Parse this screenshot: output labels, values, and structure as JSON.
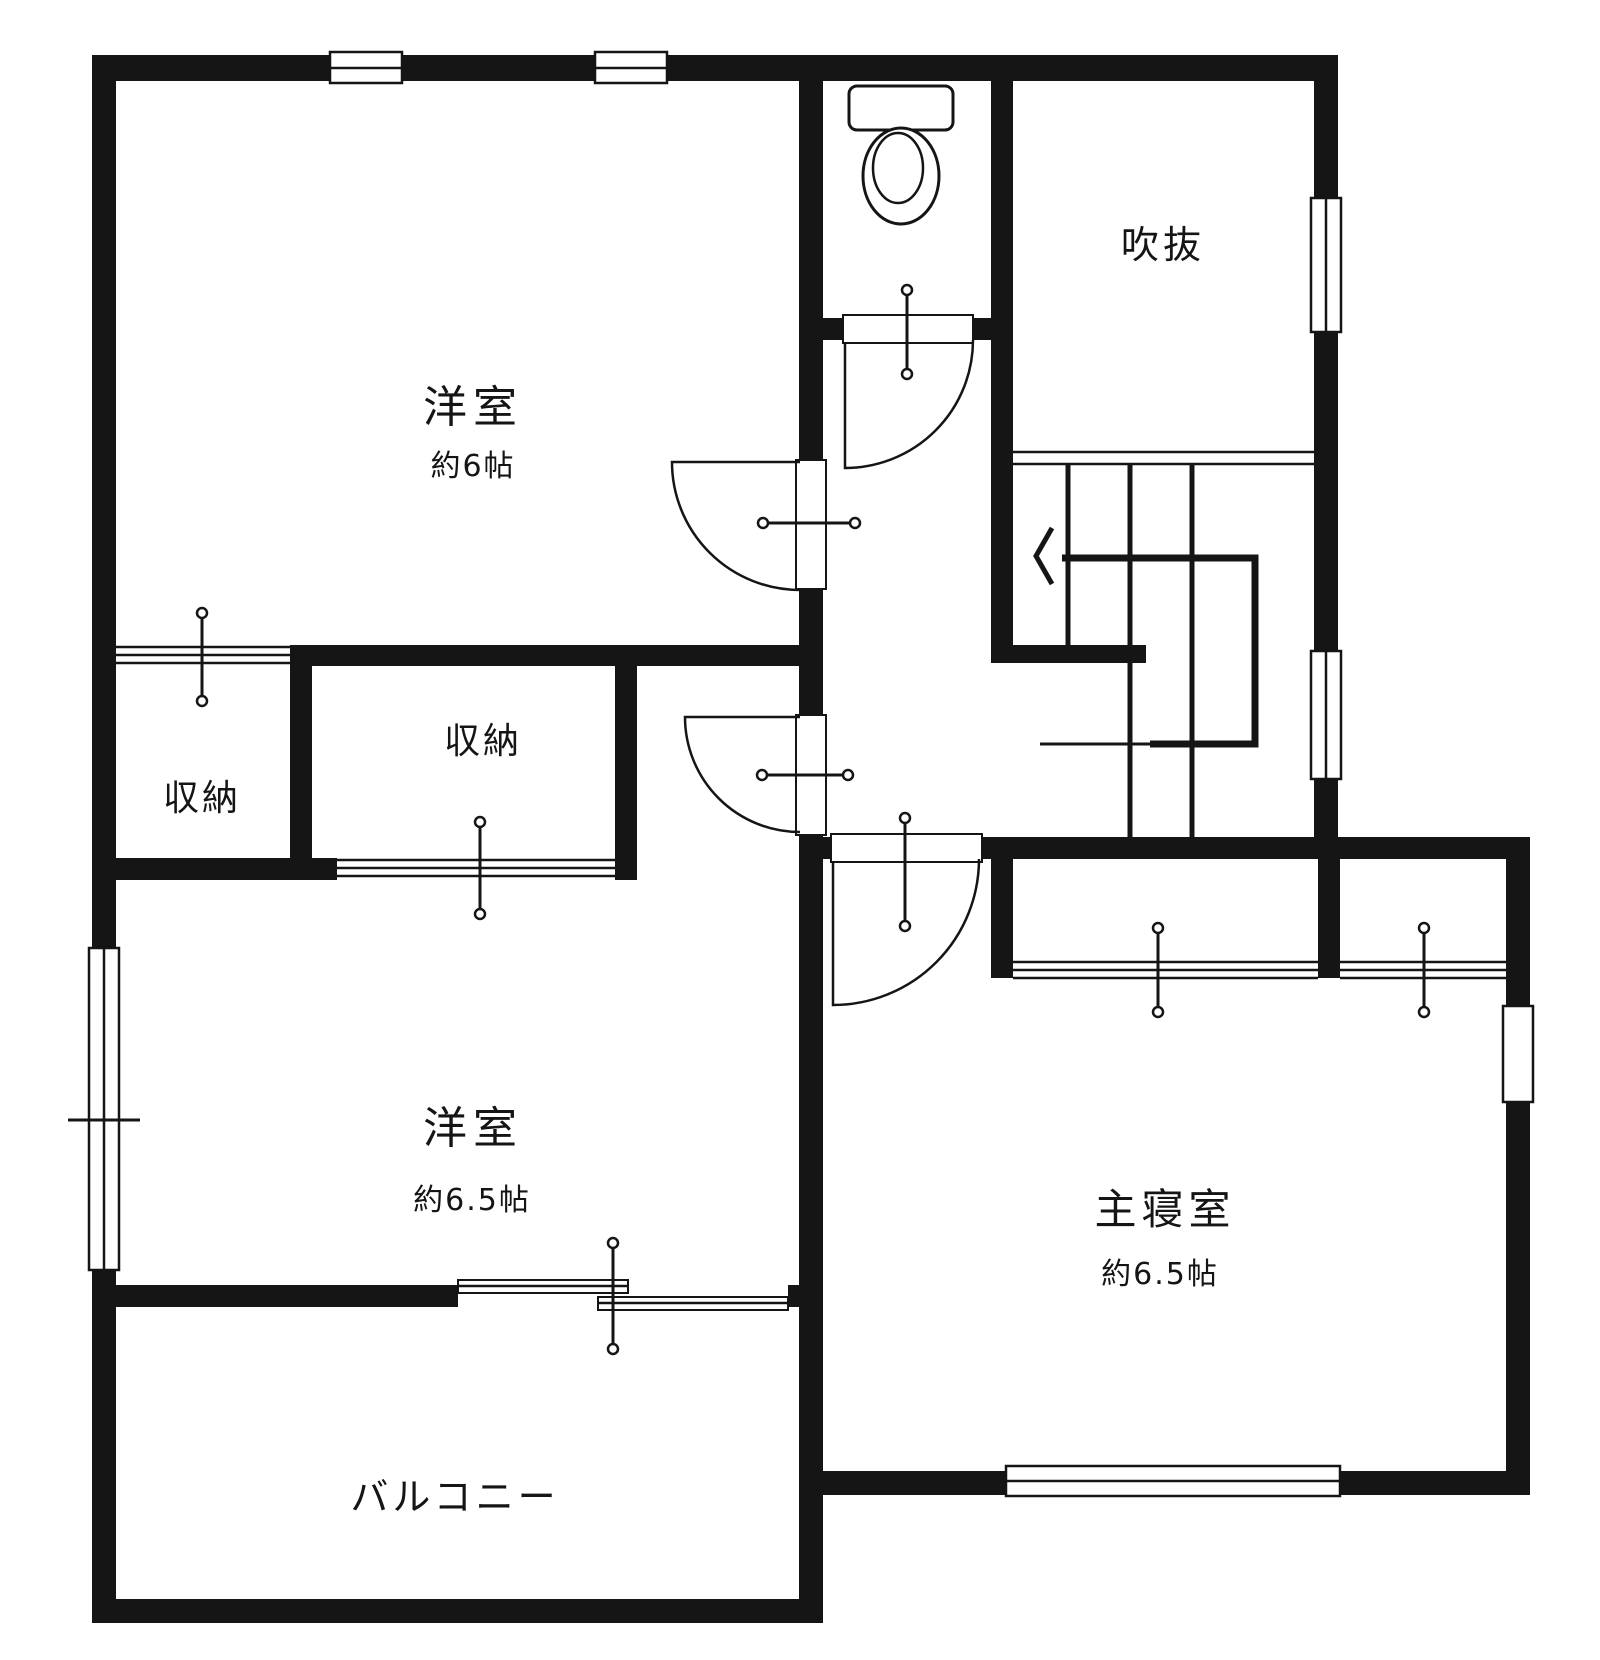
{
  "plan": {
    "type": "floor-plan",
    "colors": {
      "wall": "#151515",
      "background": "#ffffff"
    },
    "rooms": {
      "western6": {
        "name": "洋室",
        "area": "約6帖"
      },
      "void": {
        "name": "吹抜"
      },
      "closet_left": {
        "name": "収納"
      },
      "closet_center": {
        "name": "収納"
      },
      "western65": {
        "name": "洋室",
        "area": "約6.5帖"
      },
      "master": {
        "name": "主寝室",
        "area": "約6.5帖"
      },
      "balcony": {
        "name": "バルコニー"
      }
    },
    "icons": {
      "toilet": "toilet-plan-icon",
      "stairs_arrow": "stairs-down-arrow-icon"
    }
  }
}
